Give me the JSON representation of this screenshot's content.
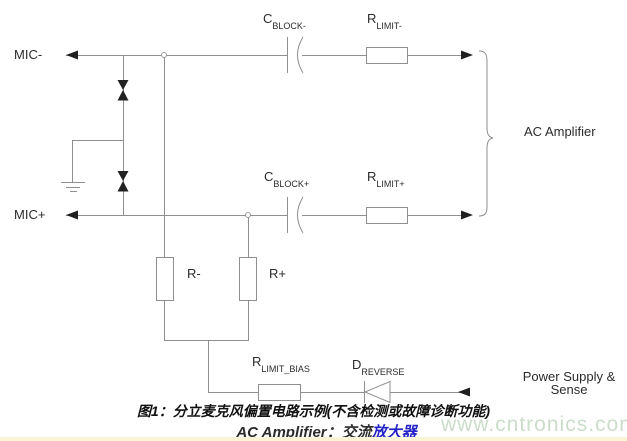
{
  "figure": {
    "inputs": {
      "mic_minus": "MIC-",
      "mic_plus": "MIC+"
    },
    "components": {
      "c_block_minus": {
        "base": "C",
        "sub": "BLOCK-"
      },
      "r_limit_minus": {
        "base": "R",
        "sub": "LIMIT-"
      },
      "c_block_plus": {
        "base": "C",
        "sub": "BLOCK+"
      },
      "r_limit_plus": {
        "base": "R",
        "sub": "LIMIT+"
      },
      "r_minus": "R-",
      "r_plus": "R+",
      "r_limit_bias": {
        "base": "R",
        "sub": "LIMIT_BIAS"
      },
      "d_reverse": {
        "base": "D",
        "sub": "REVERSE"
      }
    },
    "annotations": {
      "ac_amplifier": "AC Amplifier",
      "power_supply_line1": "Power Supply &",
      "power_supply_line2": "Sense"
    }
  },
  "caption": {
    "line1": "图1：分立麦克风偏置电路示例(不含检测或故障诊断功能)",
    "line2_prefix": "AC Amplifier：交流",
    "line2_link": "放大器"
  },
  "watermark": "www.cntronics.com",
  "colors": {
    "wire": "#8f8f8f",
    "label_text": "#2b2b2b",
    "caption_link": "#2323c8",
    "watermark_green": "#ccdcca",
    "bottom_strip": "#f8f4d6"
  }
}
